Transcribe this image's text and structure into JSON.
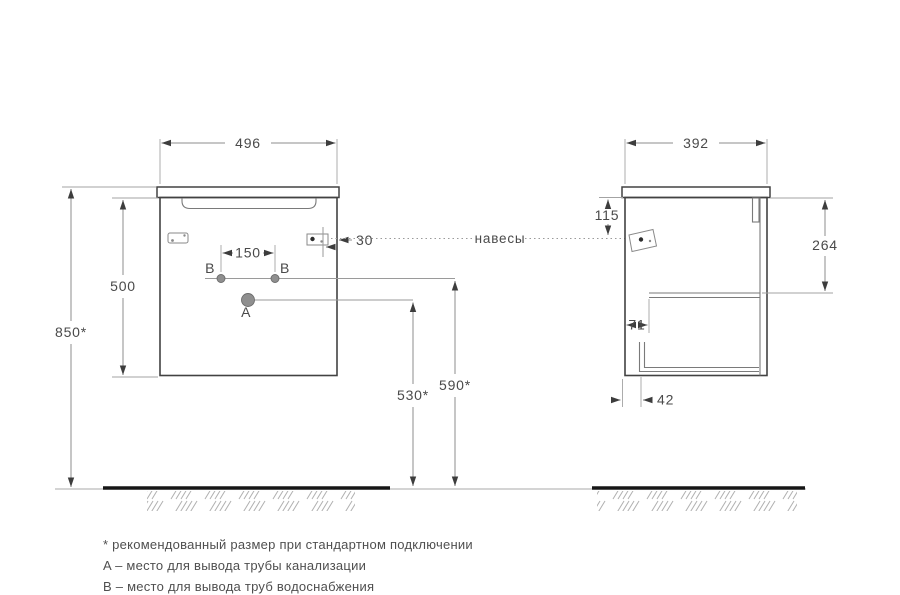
{
  "colors": {
    "outline": "#424242",
    "dimension_line": "#8c8c8c",
    "text": "#4a4a4a",
    "floor": "#161616"
  },
  "front_view": {
    "width": "496",
    "cabinet_height": "500",
    "total_height": "850*",
    "holes_spacing": "150",
    "hanger_offset": "30",
    "drain_height": "530*",
    "supply_height": "590*",
    "drain_point_label": "A",
    "supply_point_left_label": "B",
    "supply_point_right_label": "B"
  },
  "side_view": {
    "depth": "392",
    "hanger_drop": "115",
    "shelf_drop": "264",
    "shelf_inset": "71",
    "bottom_inset": "42"
  },
  "annotations": {
    "hangers_label": "навесы",
    "footnotes": [
      "* рекомендованный размер при стандартном подключении",
      "A – место для вывода трубы канализации",
      "B – место для вывода труб водоснабжения"
    ]
  }
}
